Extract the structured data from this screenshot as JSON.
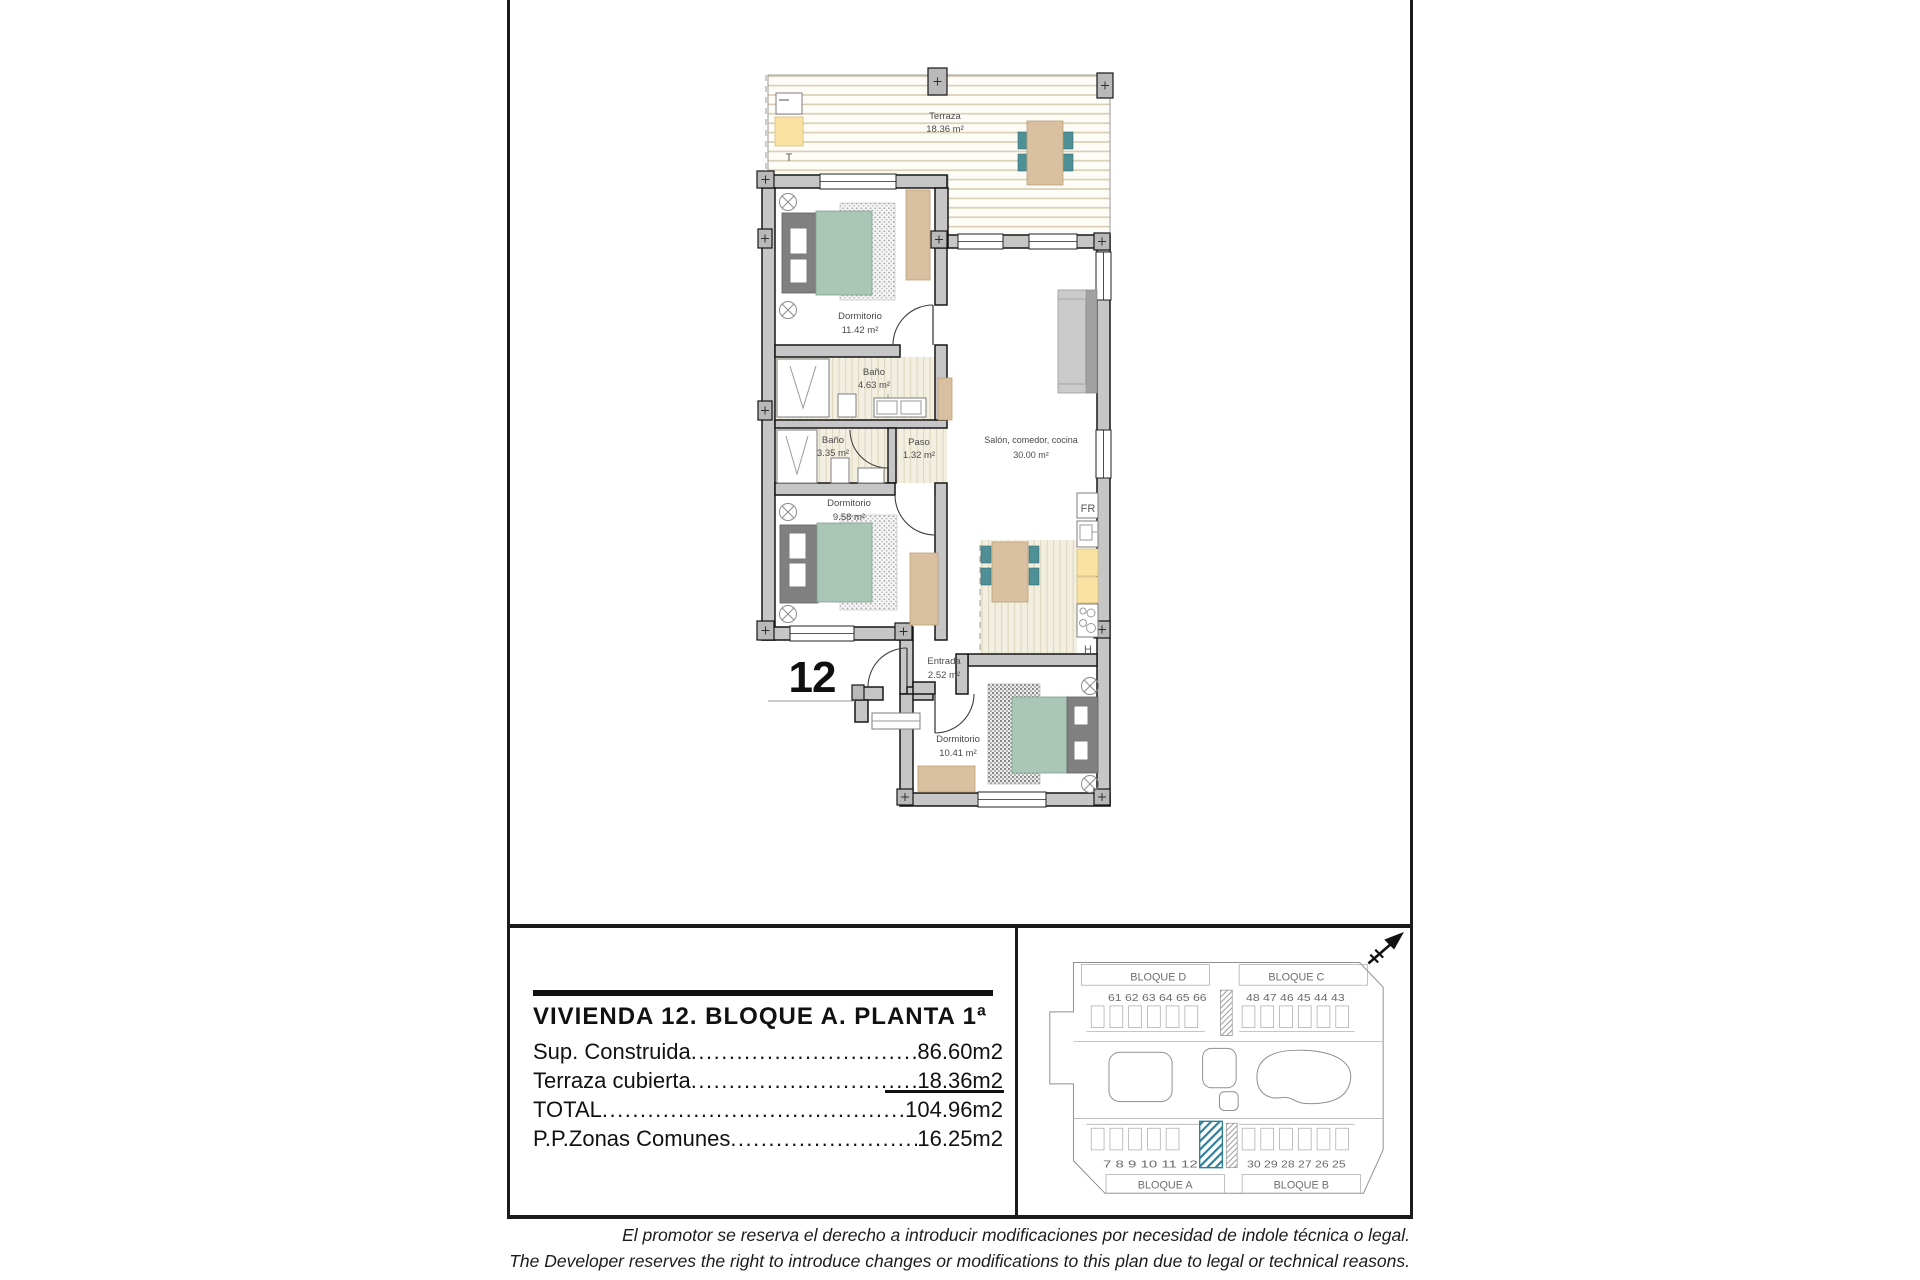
{
  "plan": {
    "unit_number": "12",
    "rooms": [
      {
        "name": "Terraza",
        "area": "18.36 m²"
      },
      {
        "name": "Dormitorio",
        "area": "11.42 m²"
      },
      {
        "name": "Baño",
        "area": "4.63 m²"
      },
      {
        "name": "Baño",
        "area": "3.35 m²"
      },
      {
        "name": "Paso",
        "area": "1.32 m²"
      },
      {
        "name": "Salón, comedor, cocina",
        "area": "30.00 m²"
      },
      {
        "name": "Dormitorio",
        "area": "9.58 m²"
      },
      {
        "name": "Entrada",
        "area": "2.52 m²"
      },
      {
        "name": "Dormitorio",
        "area": "10.41 m²"
      }
    ],
    "labels": {
      "terrace": "T",
      "fridge": "FR",
      "hob": "H"
    }
  },
  "info": {
    "title": "VIVIENDA 12. BLOQUE A. PLANTA 1ª",
    "rows": [
      {
        "label": "Sup. Construida",
        "value": "86.60m2"
      },
      {
        "label": "Terraza cubierta",
        "value": "18.36m2"
      },
      {
        "label": "TOTAL",
        "value": "104.96m2"
      },
      {
        "label": "P.P.Zonas Comunes",
        "value": "16.25m2"
      }
    ]
  },
  "site": {
    "blocks": [
      "BLOQUE D",
      "BLOQUE C",
      "BLOQUE A",
      "BLOQUE B"
    ],
    "units_top_left": "61 62  63  64  65 66",
    "units_top_right": "48 47  46  45  44 43",
    "units_bottom_left": "7  8   9   10  11 12",
    "units_bottom_right": "30 29  28  27  26 25",
    "highlighted_unit": "12",
    "highlight_color": "#2e7f99"
  },
  "disclaimer": {
    "line_es": "El promotor se reserva el derecho a introducir modificaciones por necesidad de indole técnica o legal.",
    "line_en": "The Developer reserves the right to introduce changes or modifications to this plan due to legal or technical reasons."
  },
  "colors": {
    "wall": "#c6c6c6",
    "teal": "#a9c6b6",
    "wood": "#d9c0a0",
    "yellow": "#f9e2a2",
    "accent": "#2e7f99"
  }
}
